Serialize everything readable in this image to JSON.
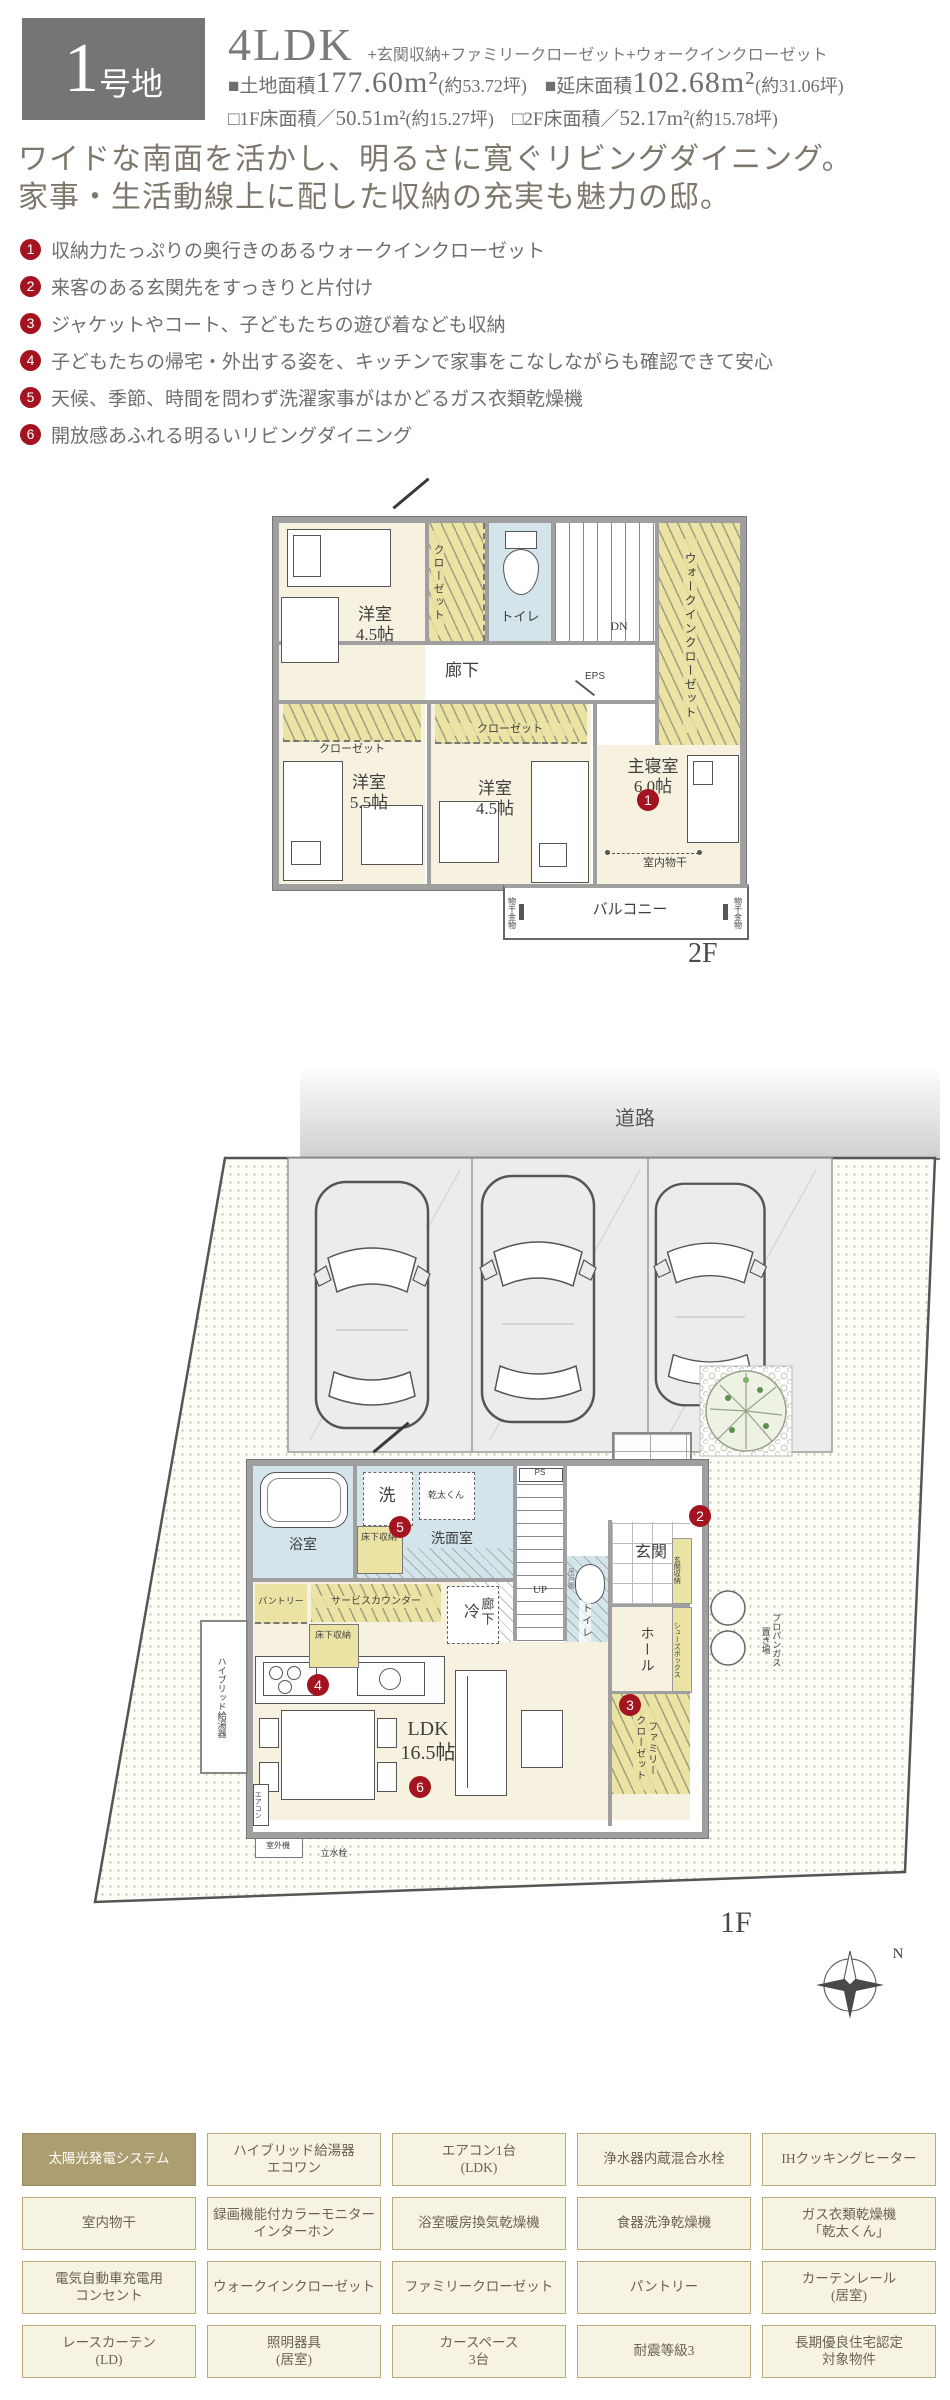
{
  "colors": {
    "accent_red": "#a31420",
    "wall_gray": "#9f9f9f",
    "room_cream": "#f6f2df",
    "closet_yellow": "#ebe3a4",
    "wet_blue": "#d3e4ea",
    "olive_highlight": "#ac9e71",
    "cell_bg": "#f7f3e3",
    "cell_border": "#b9a97c",
    "lot_box_gray": "#757575"
  },
  "header": {
    "lot_big": "1",
    "lot_small": "号地",
    "plan_type": "4LDK",
    "plan_suffix": "+玄関収納+ファミリークローゼット+ウォークインクローゼット",
    "land": {
      "label": "■土地面積",
      "value": "177.60m²",
      "tsubo": "(約53.72坪)"
    },
    "total": {
      "label": "■延床面積",
      "value": "102.68m²",
      "tsubo": "(約31.06坪)"
    },
    "f1": {
      "label": "□1F床面積／",
      "value": "50.51m²",
      "tsubo": "(約15.27坪)"
    },
    "f2": {
      "label": "□2F床面積／",
      "value": "52.17m²",
      "tsubo": "(約15.78坪)"
    }
  },
  "catchphrase": {
    "line1": "ワイドな南面を活かし、明るさに寛ぐリビングダイニング。",
    "line2": "家事・生活動線上に配した収納の充実も魅力の邸。"
  },
  "features": {
    "items": [
      {
        "num": "1",
        "text": "収納力たっぷりの奥行きのあるウォークインクローゼット"
      },
      {
        "num": "2",
        "text": "来客のある玄関先をすっきりと片付け"
      },
      {
        "num": "3",
        "text": "ジャケットやコート、子どもたちの遊び着なども収納"
      },
      {
        "num": "4",
        "text": "子どもたちの帰宅・外出する姿を、キッチンで家事をこなしながらも確認できて安心"
      },
      {
        "num": "5",
        "text": "天候、季節、時間を問わず洗濯家事がはかどるガス衣類乾燥機"
      },
      {
        "num": "6",
        "text": "開放感あふれる明るいリビングダイニング"
      }
    ]
  },
  "plan2f": {
    "floor_label": "2F",
    "room_yoshitsu_a": "洋室\n4.5帖",
    "closet_a": "クローゼット",
    "toilet": "トイレ",
    "dn": "DN",
    "eps": "EPS",
    "wic": "ウォークインクローゼット",
    "hallway": "廊下",
    "room_yoshitsu_b": "洋室\n5.5帖",
    "closet_b": "クローゼット",
    "room_yoshitsu_c": "洋室\n4.5帖",
    "closet_c": "クローゼット",
    "master": "主寝室\n6.0帖",
    "monohoshi": "室内物干",
    "balcony": "バルコニー",
    "hoshi_kanamono_l": "物干金物",
    "hoshi_kanamono_r": "物干金物"
  },
  "plan1f": {
    "floor_label": "1F",
    "road": "道路",
    "bath": "浴室",
    "washer": "洗",
    "dryer": "乾太くん",
    "washroom": "洗面室",
    "yukashita_a": "床下収納",
    "ps": "PS",
    "up": "UP",
    "hallway": "廊下",
    "toilet": "トイレ",
    "tsurito": "吊戸棚",
    "genkan": "玄関",
    "genkan_shuno": "玄関収納",
    "porch": "ポーチ",
    "hall": "ホール",
    "shoes_box": "シューズボックス",
    "family_closet": "ファミリー\nクローゼット",
    "pantry": "パントリー",
    "service_counter": "サービスカウンター",
    "fridge": "冷",
    "yukashita_b": "床下収納",
    "ldk": "LDK\n16.5帖",
    "aircon": "エアコン",
    "boiler": "ハイブリッド給湯器",
    "outdoor_unit": "室外機",
    "tap": "立水栓",
    "propane": "プロパンガス\n置き場",
    "compass_n": "N"
  },
  "equipment": {
    "rows": [
      [
        "太陽光発電システム",
        "ハイブリッド給湯器\nエコワン",
        "エアコン1台\n(LDK)",
        "浄水器内蔵混合水栓",
        "IHクッキングヒーター"
      ],
      [
        "室内物干",
        "録画機能付カラーモニター\nインターホン",
        "浴室暖房換気乾燥機",
        "食器洗浄乾燥機",
        "ガス衣類乾燥機\n「乾太くん」"
      ],
      [
        "電気自動車充電用\nコンセント",
        "ウォークインクローゼット",
        "ファミリークローゼット",
        "パントリー",
        "カーテンレール\n(居室)"
      ],
      [
        "レースカーテン\n(LD)",
        "照明器具\n(居室)",
        "カースペース\n3台",
        "耐震等級3",
        "長期優良住宅認定\n対象物件"
      ]
    ]
  }
}
